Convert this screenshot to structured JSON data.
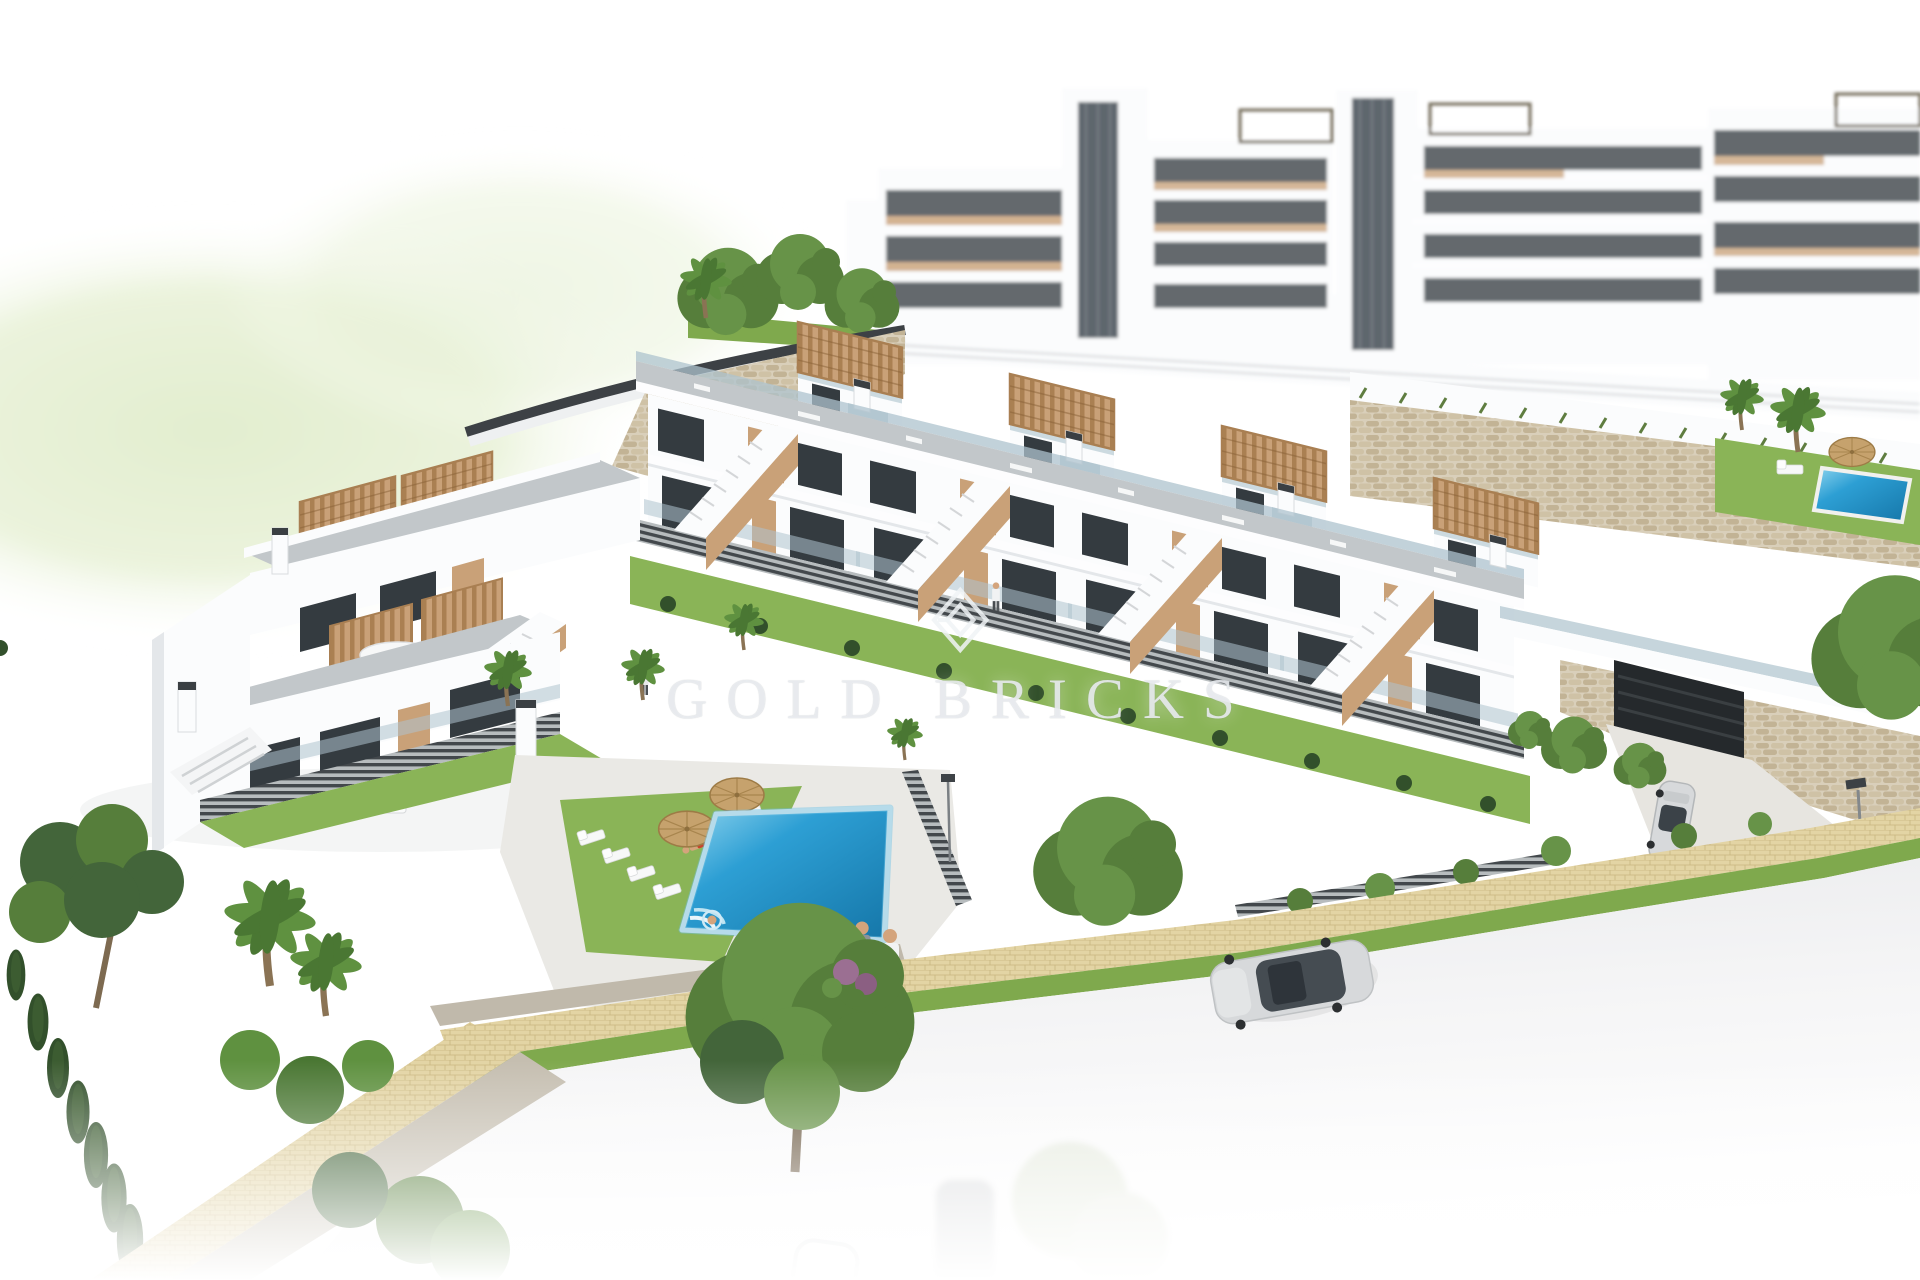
{
  "watermark": {
    "text": "GOLD BRICKS",
    "logo": "gold-bricks-diamond-logo"
  },
  "colors": {
    "background": "#ffffff",
    "building_white": "#fbfcfd",
    "facade_shade": "#e4e7ea",
    "roof_deck": "#c2c7ca",
    "wood_tan": "#c9a178",
    "wood_tan_dark": "#aa8052",
    "window_glass": "#343b40",
    "glass_railing": "#aec3cd",
    "stone_beige": "#d9cfba",
    "stone_light": "#cfc2a6",
    "stone_dark": "#c2b395",
    "grass": "#7fa94d",
    "lawn": "#8ab457",
    "hedge": "#32502b",
    "tree": "#567e3b",
    "tree_light": "#679348",
    "tree_dark": "#43653a",
    "palm": "#5f9140",
    "palm_dark": "#4a7733",
    "pool_blue": "#2596cc",
    "walkway_sand": "#e3d4a4",
    "road": "#ededef",
    "fence_dark": "#43484c",
    "fence_gap": "#b7bcbe",
    "car_silver": "#d7d9db",
    "umbrella_straw": "#c6a26d",
    "swimsuit_red": "#c8452c",
    "skin": "#d4a47c",
    "watermark_tint": "#f2f4f6"
  },
  "scene": {
    "type": "aerial-architectural-render",
    "objects": [
      "background-apartment-complex",
      "stone-retaining-walls",
      "townhouse-row-with-roof-terraces",
      "left-townhouse-block",
      "communal-pool",
      "sun-loungers",
      "straw-umbrellas",
      "white-roof-umbrella",
      "rooftop-pergolas",
      "staircases",
      "glass-balustrades",
      "front-gardens",
      "hedges",
      "slat-fences",
      "center-tree",
      "palm-trees",
      "cypress-row",
      "pine-tree",
      "yellow-paved-walkway",
      "grass-verge",
      "road",
      "white-sedan",
      "silver-sports-car",
      "garage-entrance",
      "driveway",
      "street-lamp",
      "pedestrians",
      "swimmer",
      "sunbather",
      "ghost-cars",
      "gold-bricks-watermark"
    ]
  }
}
